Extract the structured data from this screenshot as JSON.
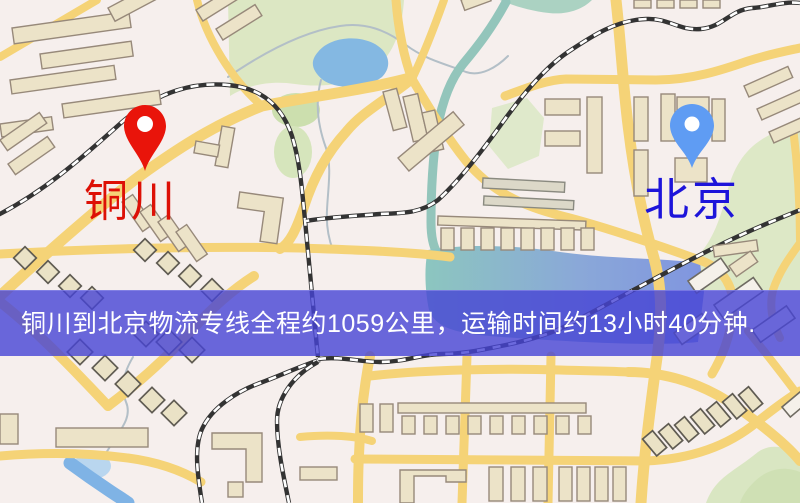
{
  "markers": {
    "origin": {
      "name": "铜川",
      "pin_color": "#e9140a",
      "label_color": "#dd1006"
    },
    "destination": {
      "name": "北京",
      "pin_color": "#5f9cf3",
      "label_color": "#1d14da"
    }
  },
  "banner": {
    "text": "铜川到北京物流专线全程约1059公里，运输时间约13小时40分钟.",
    "background": "rgba(70,68,212,0.8)",
    "text_color": "#ffffff"
  },
  "map": {
    "type": "street-map",
    "colors": {
      "background": "#f6efed",
      "road": "#f5d377",
      "building": "#ece3c8",
      "building_light": "#f5f1ea",
      "park": "#dce7c3",
      "pond": "#84b8e2",
      "river_teal": "#8cc6bf",
      "river_blue": "#8095e0",
      "railway": "#333333"
    }
  }
}
